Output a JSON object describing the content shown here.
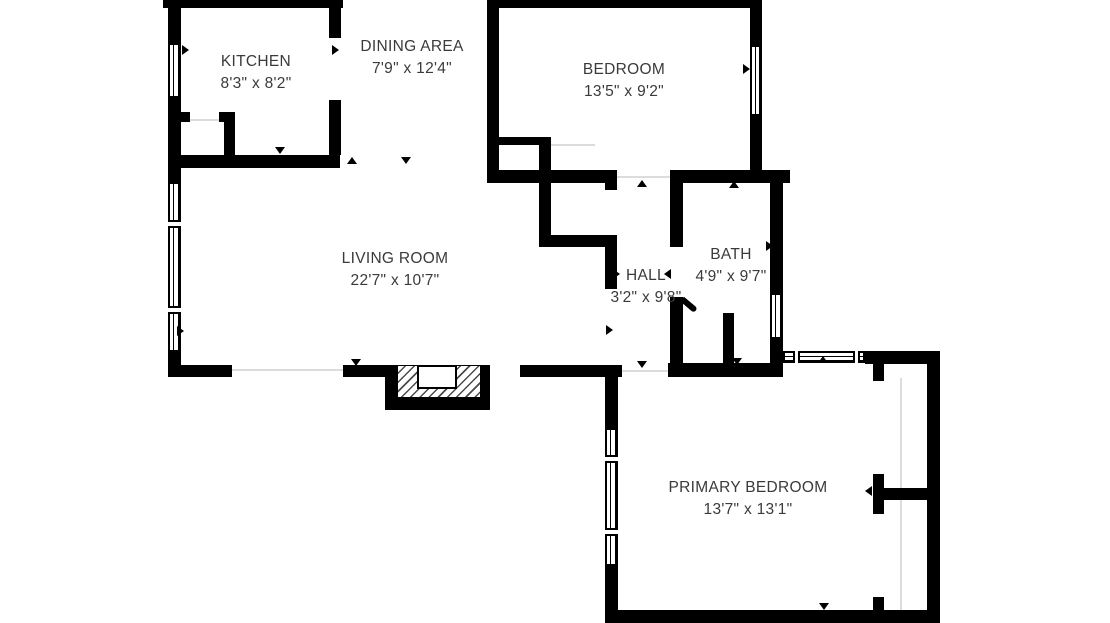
{
  "title": "Apartment floor plan",
  "colors": {
    "wall": "#000000",
    "background": "#ffffff",
    "label_text": "#3a3a3a",
    "light_line": "#dcdcdc"
  },
  "icons": {
    "direction_marker": "small solid black triangle",
    "window_symbol": "white double-line window in wall",
    "door_swing": "angled black door leaf",
    "fireplace": "diagonal hatched chimney with white firebox"
  },
  "rooms": [
    {
      "name": "KITCHEN",
      "dims": "8'3\" x 8'2\""
    },
    {
      "name": "DINING AREA",
      "dims": "7'9\" x 12'4\""
    },
    {
      "name": "BEDROOM",
      "dims": "13'5\" x 9'2\""
    },
    {
      "name": "LIVING ROOM",
      "dims": "22'7\" x 10'7\""
    },
    {
      "name": "HALL",
      "dims": "3'2\" x 9'8\""
    },
    {
      "name": "BATH",
      "dims": "4'9\" x 9'7\""
    },
    {
      "name": "PRIMARY BEDROOM",
      "dims": "13'7\" x 13'1\""
    }
  ]
}
